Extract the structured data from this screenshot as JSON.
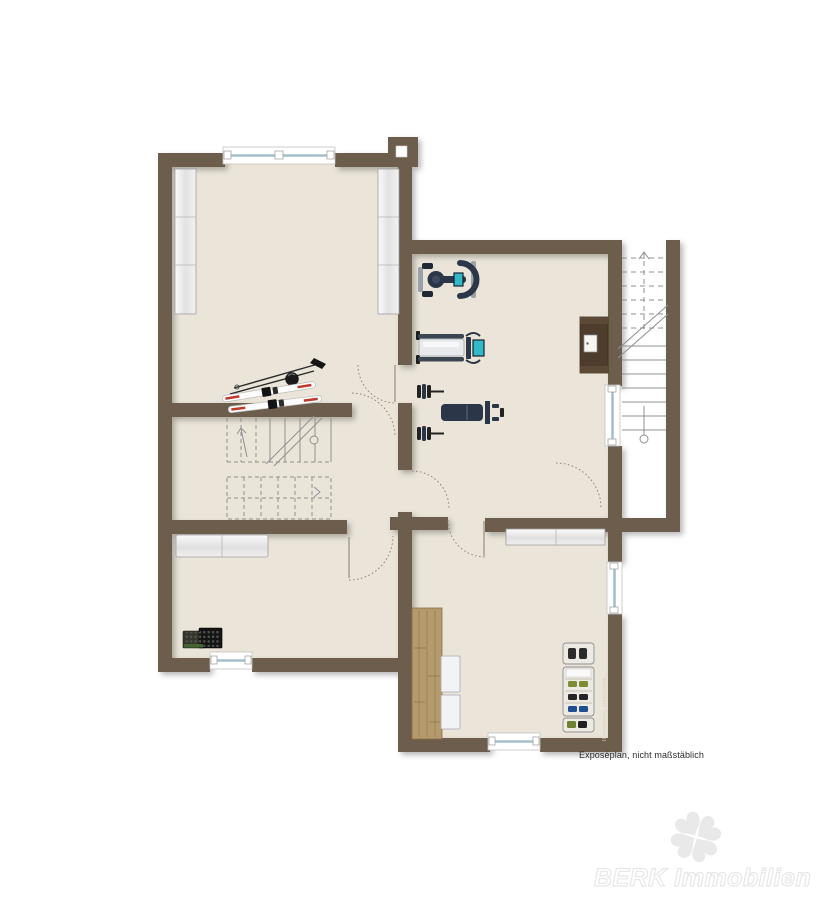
{
  "texts": {
    "footer_note": "Exposéplan, nicht maßstäblich",
    "credit": "Illustration©immoGrafik",
    "brand_watermark": "BERK Immobilien"
  },
  "colors": {
    "wall": "#6c5d4d",
    "floor": "#ebe5d9",
    "background": "#ffffff",
    "wood": "#b49a6d",
    "window_glass": "#a3bfcb",
    "equipment_dark": "#2b3648",
    "equipment_accent": "#2fb9c9",
    "stair_line": "#909090",
    "door_arc": "#8a7d6a",
    "watermark_gray": "#e9e9e9"
  },
  "icons": {
    "ski-set-icon": "two pairs of skis with poles lying on floor",
    "exercise-bike-icon": "exercise bike top view with teal display",
    "treadmill-icon": "treadmill top view with teal display",
    "weight-bench-icon": "weight bench with dumbbell racks",
    "wine-rack-icon": "dark bottle crate grid",
    "shoe-rack-icon": "shelf with shoe pairs",
    "shelf-unit-icon": "white storage shelf",
    "workbench-icon": "wooden counter with grain",
    "wall-cabinet-icon": "dark wall-mounted box with white panel",
    "interior-staircase-icon": "winder stair with break line",
    "exterior-staircase-icon": "straight stair with break line and newel circle",
    "window-icon": "white frame with glass line and handles",
    "door-swing-icon": "dotted quarter-circle arc",
    "chimney-icon": "wall block with white flue square",
    "clover-icon": "light gray four-leaf clover"
  },
  "furniture_inventory": [
    "shelf-unit",
    "shelf-unit",
    "ski-set",
    "exercise-bike",
    "treadmill",
    "weight-bench",
    "wall-cabinet",
    "sideboard",
    "wine-rack",
    "workbench",
    "side-panels",
    "top-cabinet",
    "shoe-rack"
  ],
  "plan_features": [
    "interior-staircase",
    "exterior-staircase",
    "chimney",
    "five-windows",
    "glass-door",
    "six-door-swings"
  ]
}
